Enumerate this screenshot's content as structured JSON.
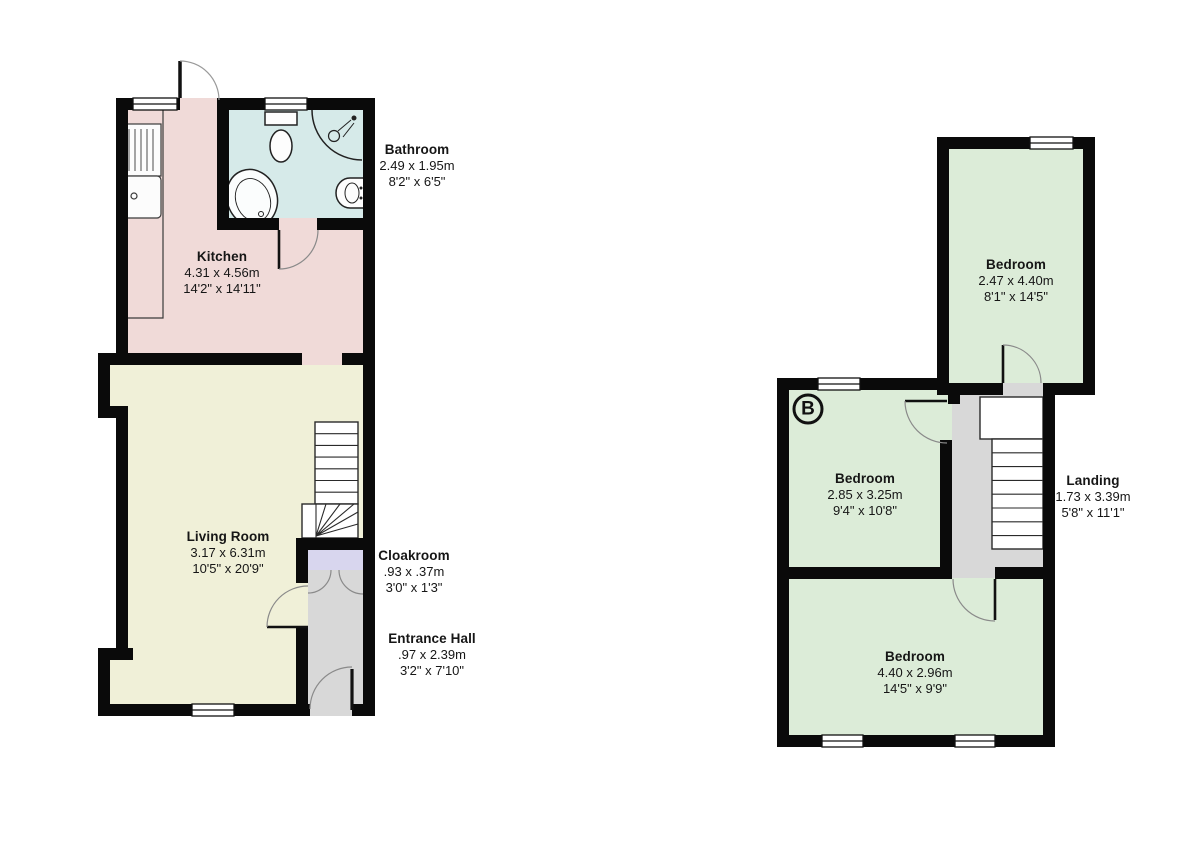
{
  "document": {
    "title": "Floor Plan"
  },
  "colors": {
    "wall": "#0a0a0a",
    "kitchen_fill": "#f0dad8",
    "bathroom_fill": "#d6eae9",
    "living_fill": "#f0f0d8",
    "hall_fill": "#d8d8d8",
    "cloakroom_fill": "#d8d6ee",
    "bedroom_fill": "#dcecd8",
    "landing_fill": "#d8d8d8",
    "stair_fill": "#ffffff"
  },
  "icons": [
    "kitchen-sink-icon",
    "toilet-icon",
    "corner-shower-icon",
    "bathtub-icon",
    "wash-basin-icon",
    "stairs-icon",
    "door-swing-icon",
    "window-icon"
  ],
  "floors": [
    {
      "id": "ground-floor",
      "rooms": [
        {
          "name": "Kitchen",
          "metric": "4.31 x 4.56m",
          "imperial": "14'2\" x 14'11\""
        },
        {
          "name": "Bathroom",
          "metric": "2.49 x 1.95m",
          "imperial": "8'2\" x 6'5\""
        },
        {
          "name": "Living Room",
          "metric": "3.17 x 6.31m",
          "imperial": "10'5\" x 20'9\""
        },
        {
          "name": "Cloakroom",
          "metric": ".93 x .37m",
          "imperial": "3'0\" x 1'3\""
        },
        {
          "name": "Entrance Hall",
          "metric": ".97 x 2.39m",
          "imperial": "3'2\" x 7'10\""
        }
      ]
    },
    {
      "id": "first-floor",
      "marker": "B",
      "rooms": [
        {
          "name": "Bedroom",
          "metric": "2.47 x 4.40m",
          "imperial": "8'1\" x 14'5\""
        },
        {
          "name": "Bedroom",
          "metric": "2.85 x 3.25m",
          "imperial": "9'4\" x 10'8\""
        },
        {
          "name": "Landing",
          "metric": "1.73 x 3.39m",
          "imperial": "5'8\" x 11'1\""
        },
        {
          "name": "Bedroom",
          "metric": "4.40 x 2.96m",
          "imperial": "14'5\" x 9'9\""
        }
      ]
    }
  ]
}
